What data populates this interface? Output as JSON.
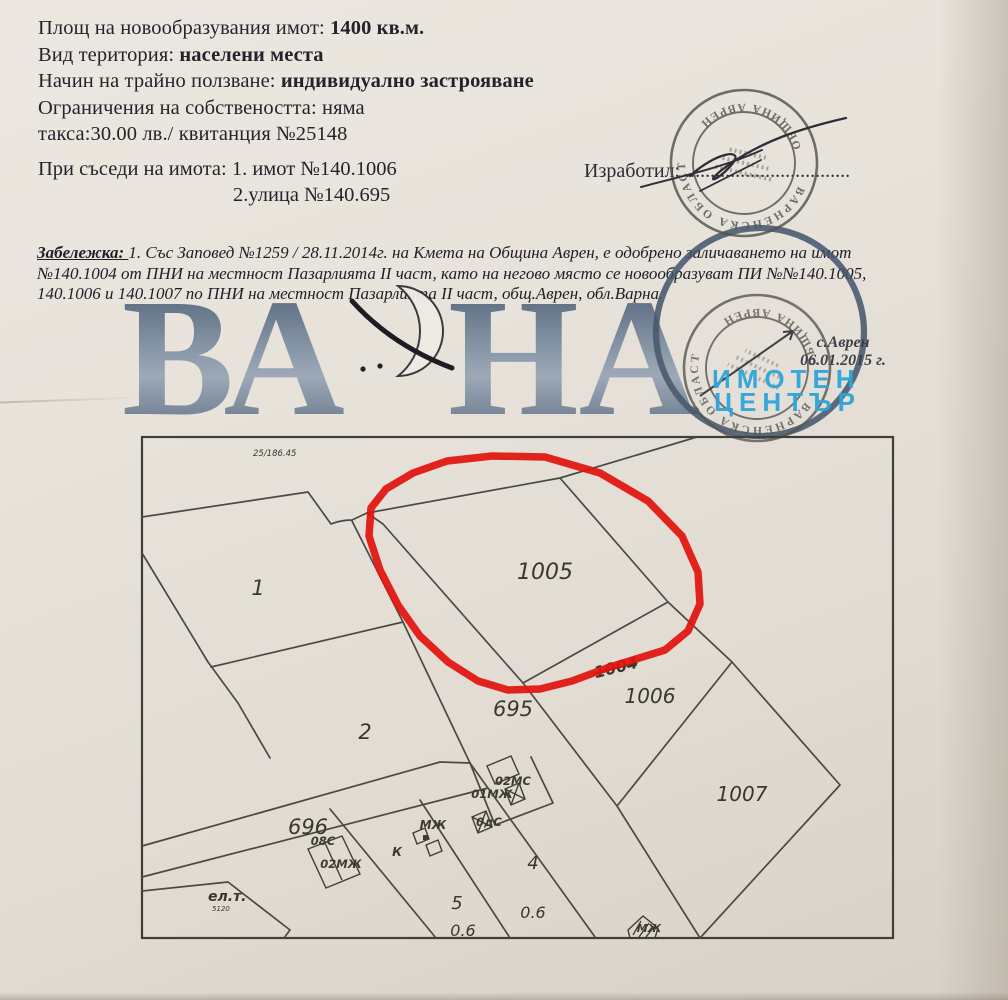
{
  "page": {
    "fields": [
      {
        "label": "Площ на новообразувания имот: ",
        "value": "1400 кв.м."
      },
      {
        "label": "Вид територия: ",
        "value": "населени места"
      },
      {
        "label": "Начин на трайно ползване: ",
        "value": "индивидуално застрояване"
      },
      {
        "label": "Ограничения на собствеността: ",
        "value": "няма"
      },
      {
        "label": "такса:30.00 лв./ квитанция №25148",
        "value": ""
      }
    ],
    "neighbors_label": "При съседи на имота: ",
    "neighbor_1": "1. имот №140.1006",
    "neighbor_2": "2.улица №140.695",
    "prepared_label": "Изработил: ",
    "prepared_dots": ".................................",
    "note_label": "Забележка: ",
    "note_line1": "1. Със Заповед №1259 / 28.11.2014г. на Кмета на Община Аврен, е одобрено заличаването на имот",
    "note_line2": "№140.1004 от ПНИ на местност Пазарлията II част, като на негово място се новообразуват ПИ №№140.1005,",
    "note_line3": "140.1006 и 140.1007 по ПНИ на местност Пазарлията II част, общ.Аврен, обл.Варна.",
    "place": "с.Аврен",
    "date": "06.01.2015 г."
  },
  "logo": {
    "text_left": "ВА",
    "text_right": "НА",
    "center_line1": "ИМОТЕН",
    "center_line2": "ЦЕНТЪР",
    "accent_color": "#2da5d9",
    "letters_color": "#44566e"
  },
  "stamp": {
    "ring_top": "ВАРНЕНСКА ОБЛАСТ",
    "ring_bottom": "ОБЩИНА АВРЕН",
    "ink_color": "#54544c"
  },
  "map": {
    "scale_note": "25/186.45",
    "p1": "1",
    "p2": "2",
    "p4": "4",
    "p5": "5",
    "p1005": "1005",
    "p1006": "1006",
    "p1007": "1007",
    "s695": "695",
    "s696": "696",
    "struck": "1004",
    "a06a": "0.6",
    "a06b": "0.6",
    "b1": "02МС",
    "b2": "01МЖ",
    "b3": "0дС",
    "b4": "МЖ",
    "b5": "К",
    "b6": "08С",
    "b7": "02МЖ",
    "b8": "МЖ",
    "elt": "ел.т.",
    "elt_num": "5120",
    "highlight_color": "#e2130e"
  }
}
